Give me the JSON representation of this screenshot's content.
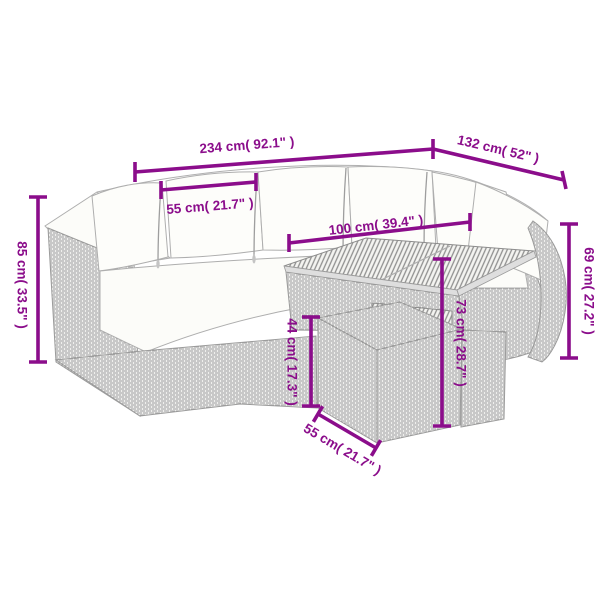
{
  "diagram": {
    "title": "Rattan garden lounge set with table and footstool — dimension drawing",
    "accent_color": "#8B0D8B",
    "outline_color": "#a3a3a3"
  },
  "dimensions": {
    "total_width": {
      "label": "234 cm( 92.1\" )"
    },
    "total_depth": {
      "label": "132 cm( 52\" )"
    },
    "seat_width": {
      "label": "55 cm( 21.7\" )"
    },
    "table_length": {
      "label": "100 cm( 39.4\" )"
    },
    "back_height": {
      "label": "85 cm( 33.5\" )"
    },
    "arm_height": {
      "label": "69 cm( 27.2\" )"
    },
    "seat_height": {
      "label": "44 cm( 17.3\" )"
    },
    "table_height": {
      "label": "73 cm( 28.7\" )"
    },
    "stool_width": {
      "label": "55 cm( 21.7\" )"
    }
  }
}
